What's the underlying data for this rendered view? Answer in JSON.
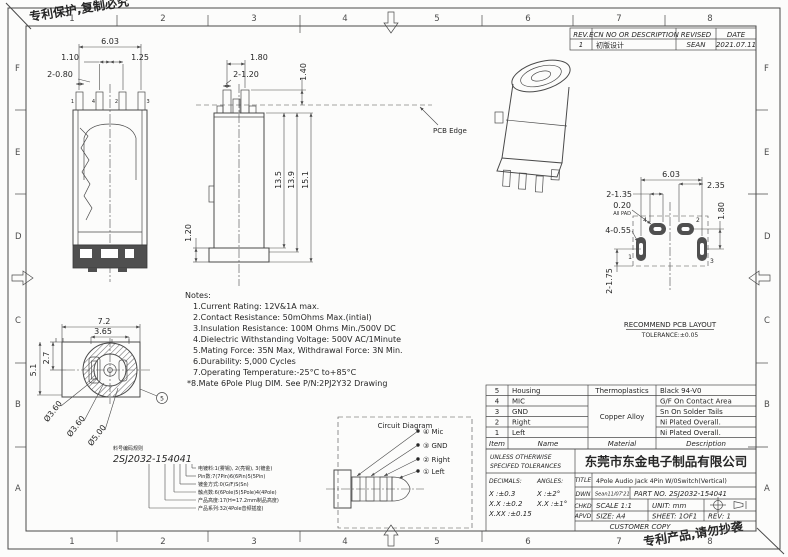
{
  "colors": {
    "line": "#4a4a4a",
    "text": "#262626",
    "dark_fill": "#4f4f4f",
    "paper": "#fcfcfb"
  },
  "frame": {
    "letters": [
      "F",
      "E",
      "D",
      "C",
      "B",
      "A"
    ],
    "numbers": [
      "1",
      "2",
      "3",
      "4",
      "5",
      "6",
      "7",
      "8"
    ]
  },
  "marks": {
    "top_left": "专利保护,复制必究",
    "bottom_right": "专利产品,请勿抄袭"
  },
  "rev_table": {
    "h": [
      "REV.",
      "ECN NO OR DESCRIPTION",
      "REVISED",
      "DATE"
    ],
    "r": [
      "1",
      "初版设计",
      "SEAN",
      "2021.07.11"
    ]
  },
  "sec": {
    "d1": "6.03",
    "d2": "1.10",
    "d3": "1.25",
    "d4": "2-0.80",
    "p1": "1",
    "p2": "4",
    "p3": "2",
    "p4": "3"
  },
  "side": {
    "d1": "1.80",
    "d2": "2-1.20",
    "d3": "1.40",
    "d4": "13.5",
    "d5": "13.9",
    "d6": "15.1",
    "d7": "1.20",
    "pcb": "PCB Edge"
  },
  "front": {
    "d1": "7.2",
    "d2": "3.65",
    "d3": "2.7",
    "d4": "5.1",
    "d5": "Ø3.60",
    "d6": "Ø3.60",
    "d7": "Ø5.00",
    "balloon": "5"
  },
  "pcb": {
    "d1": "6.03",
    "d2": "2.35",
    "d3": "2-1.35",
    "d4": "0.20",
    "d5": "All PAD",
    "d6": "4-0.55",
    "d7": "1.80",
    "d8": "2-1.75",
    "n1": "4",
    "n2": "2",
    "n3": "1",
    "n4": "3",
    "cap1": "RECOMMEND PCB LAYOUT",
    "cap2": "TOLERANCE:±0.05"
  },
  "notes": {
    "title": "Notes:",
    "items": [
      "1.Current Rating: 12V&1A max.",
      "2.Contact Resistance: 50mOhms Max.(intial)",
      "3.Insulation Resistance: 100M Ohms Min./500V DC",
      "4.Dielectric Withstanding Voltage: 500V AC/1Minute",
      "5.Mating Force: 35N Max, Withdrawal Force: 3N Min.",
      "6.Durability: 5,000 Cycles",
      "7.Operating Temperature:-25°C to+85°C",
      "*8.Mate 6Pole Plug DIM. See P/N:2PJ2Y32 Drawing"
    ]
  },
  "code": {
    "heading": "料号编码规则",
    "number": "2SJ2032-154041",
    "legend": [
      "电镀料:1(雾锡), 2(亮锡), 3(镀金)",
      "Pin数:7(7Pin)6(6Pin)5(5Pin)",
      "镀金方式:0(G/F)S(Sn)",
      "触点数:6(6Pole)5(5Pole)4(4Pole)",
      "产品高度:17(H=17.2mm制品高度)",
      "产品系列:32(4Pole音频插座)"
    ]
  },
  "circuit": {
    "title": "Circuit Diagram",
    "labels": [
      "④ Mic",
      "③ GND",
      "② Right",
      "① Left"
    ]
  },
  "bom": {
    "headers": [
      "Item",
      "Name",
      "Material",
      "Description"
    ],
    "items": [
      "5",
      "4",
      "3",
      "2",
      "1"
    ],
    "names": [
      "Housing",
      "MIC",
      "GND",
      "Right",
      "Left"
    ],
    "mat_top": "Thermoplastics",
    "mat_merged": "Copper Alloy",
    "descs": [
      "Black 94-V0",
      "G/F On Contact Area",
      "Sn On Solder Tails",
      "Ni Plated Overall.",
      "Ni Plated Overall."
    ]
  },
  "tb": {
    "un1": "UNLESS OTHERWISE",
    "un2": "SPECIFED TOLERANCES",
    "company": "东莞市东金电子制品有限公司",
    "dec": "DECIMALS:",
    "ang": "ANGLES:",
    "t1a": "X :±0.3",
    "t1b": "X :±2°",
    "t2a": "X.X :±0.2",
    "t2b": "X.X :±1°",
    "t3a": "X.XX :±0.15",
    "title_l": "TITLE",
    "title_v": "4Pole Audio Jack 4Pin W/0Switch(Vertical)",
    "dwn": "DWN",
    "dwn_v": "Sean11/07'21",
    "part": "PART NO. 2SJ2032-154041",
    "chkd": "CHKD",
    "scale": "SCALE 1:1",
    "unit": "UNIT: mm",
    "apvd": "APVD",
    "size": "SIZE: A4",
    "sheet": "SHEET: 1OF1",
    "rev": "REV: 1",
    "cust": "CUSTOMER COPY"
  }
}
